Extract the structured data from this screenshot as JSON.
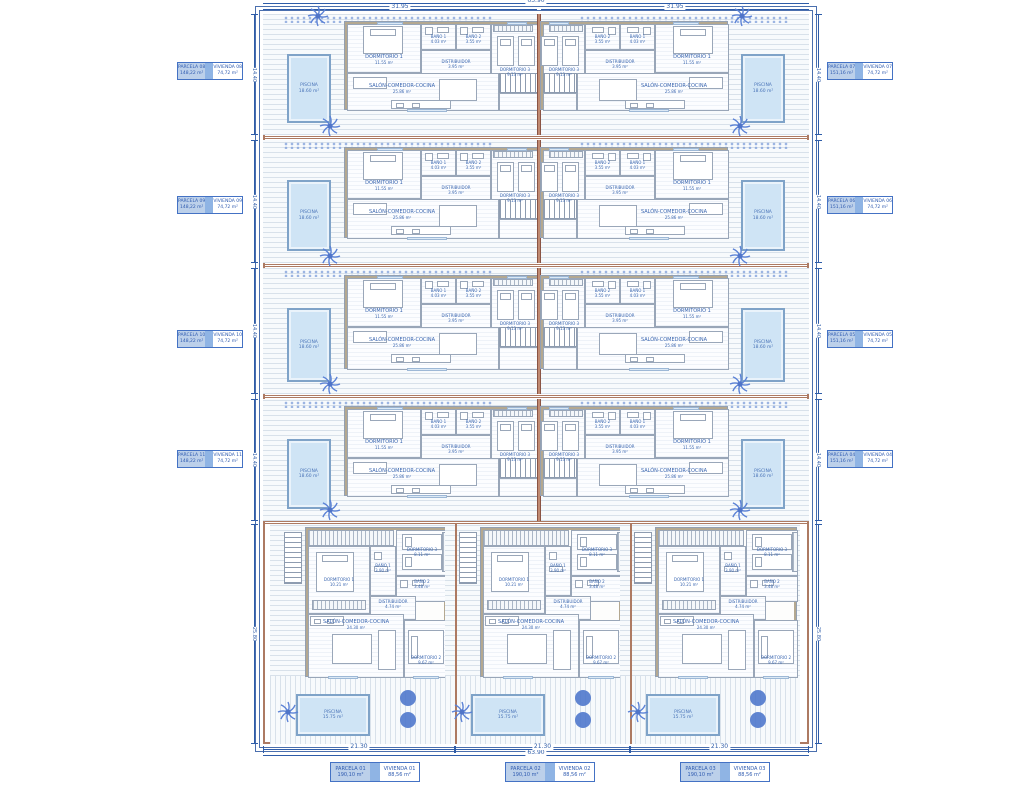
{
  "drawing": {
    "type": "residential site plan with 11 villas",
    "units_total": 11
  },
  "dims": {
    "top_overall": "63.90",
    "top_half_left": "31.95",
    "top_half_right": "31.95",
    "bottom_overall": "63.90",
    "bottom_segments": [
      "21.30",
      "21.30",
      "21.30"
    ],
    "left_rows": [
      "14.40",
      "14.40",
      "14.40",
      "14.40",
      "25.80"
    ],
    "right_rows": [
      "14.40",
      "14.40",
      "14.40",
      "14.40",
      "25.80"
    ]
  },
  "parcels": {
    "left": [
      {
        "parcela": "PARCELA 08",
        "parcela_area": "148,22 m²",
        "vivienda": "VIVIENDA 08",
        "vivienda_area": "74,72 m²"
      },
      {
        "parcela": "PARCELA 09",
        "parcela_area": "148,22 m²",
        "vivienda": "VIVIENDA 09",
        "vivienda_area": "74,72 m²"
      },
      {
        "parcela": "PARCELA 10",
        "parcela_area": "148,22 m²",
        "vivienda": "VIVIENDA 10",
        "vivienda_area": "74,72 m²"
      },
      {
        "parcela": "PARCELA 11",
        "parcela_area": "148,22 m²",
        "vivienda": "VIVIENDA 11",
        "vivienda_area": "74,72 m²"
      }
    ],
    "right": [
      {
        "parcela": "PARCELA 07",
        "parcela_area": "151,16 m²",
        "vivienda": "VIVIENDA 07",
        "vivienda_area": "74,72 m²"
      },
      {
        "parcela": "PARCELA 06",
        "parcela_area": "151,16 m²",
        "vivienda": "VIVIENDA 06",
        "vivienda_area": "74,72 m²"
      },
      {
        "parcela": "PARCELA 05",
        "parcela_area": "151,16 m²",
        "vivienda": "VIVIENDA 05",
        "vivienda_area": "74,72 m²"
      },
      {
        "parcela": "PARCELA 04",
        "parcela_area": "151,16 m²",
        "vivienda": "VIVIENDA 04",
        "vivienda_area": "74,72 m²"
      }
    ],
    "bottom": [
      {
        "parcela": "PARCELA 01",
        "parcela_area": "190,10 m²",
        "vivienda": "VIVIENDA 01",
        "vivienda_area": "88,56 m²"
      },
      {
        "parcela": "PARCELA 02",
        "parcela_area": "190,10 m²",
        "vivienda": "VIVIENDA 02",
        "vivienda_area": "88,56 m²"
      },
      {
        "parcela": "PARCELA 03",
        "parcela_area": "190,10 m²",
        "vivienda": "VIVIENDA 03",
        "vivienda_area": "88,56 m²"
      }
    ]
  },
  "upper_unit_rooms": {
    "dorm1": {
      "label": "DORMITORIO 1",
      "area": "11.55 m²"
    },
    "bano1": {
      "label": "BAÑO 1",
      "area": "4.03 m²"
    },
    "bano2": {
      "label": "BAÑO 2",
      "area": "3.55 m²"
    },
    "dorm3": {
      "label": "DORMITORIO 3",
      "area": "9.13 m²"
    },
    "distribuidor": {
      "label": "DISTRIBUIDOR",
      "area": "3.95 m²"
    },
    "salon": {
      "label": "SALÓN-COMEDOR-COCINA",
      "area": "25.86 m²"
    },
    "lavadero": {
      "label": "LAVADERO",
      "area": "2.10 m²"
    },
    "piscina": {
      "label": "PISCINA",
      "area": "18.60 m²"
    }
  },
  "bottom_unit_rooms": {
    "dorm1": {
      "label": "DORMITORIO 1",
      "area": "10.21 m²"
    },
    "dorm2": {
      "label": "DORMITORIO 2",
      "area": "9.67 m²"
    },
    "dorm3": {
      "label": "DORMITORIO 3",
      "area": "8.11 m²"
    },
    "bano1": {
      "label": "BAÑO 1",
      "area": "3.90 m²"
    },
    "bano2": {
      "label": "BAÑO 2",
      "area": "3.48 m²"
    },
    "distribuidor": {
      "label": "DISTRIBUIDOR",
      "area": "4.74 m²"
    },
    "salon": {
      "label": "SALÓN-COMEDOR-COCINA",
      "area": "24.30 m²"
    },
    "piscina": {
      "label": "PISCINA",
      "area": "15.75 m²"
    }
  },
  "colors": {
    "dimension_blue": "#2e5ca8",
    "parcel_boundary_brown": "#ad7a62",
    "label_text_blue": "#3a66b0",
    "label_cell_fill": "#bcd0ea",
    "label_spacer_fill": "#8fb4e4",
    "pool_fill": "#cfe4f5",
    "pool_border": "#7fa3c8",
    "vegetation_blue": "#5b82d6",
    "wall_gray": "#99a6b8",
    "wall_tan": "#b4a890"
  }
}
